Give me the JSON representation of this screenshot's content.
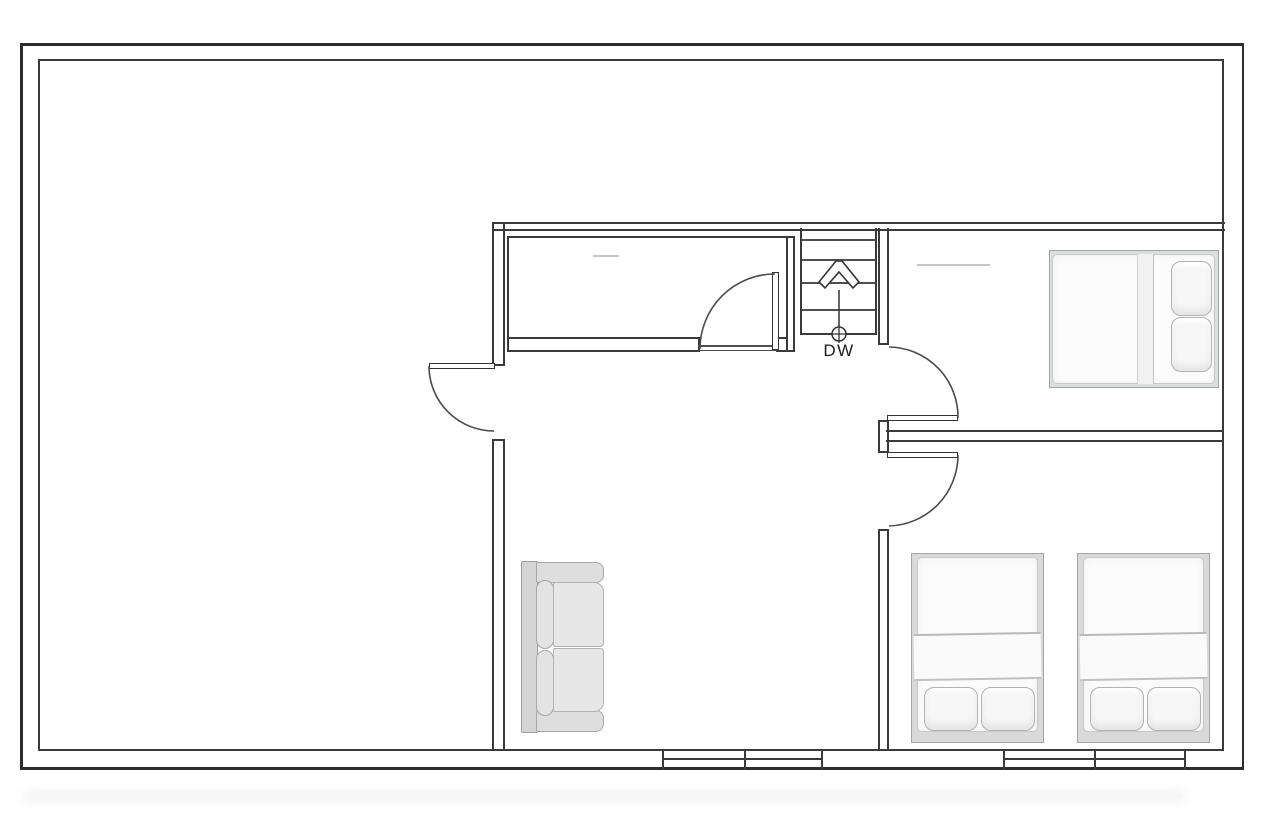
{
  "floor_plan": {
    "stairs": {
      "label": "DW",
      "direction_arrow": "up",
      "tread_count": 5,
      "fixture_symbol": "circle-cross"
    },
    "rooms": [
      {
        "name": "large-open-room",
        "furniture": []
      },
      {
        "name": "top-middle-room",
        "furniture": []
      },
      {
        "name": "central-room",
        "furniture": [
          "two-seat-sofa"
        ]
      },
      {
        "name": "bedroom-top-right",
        "furniture": [
          "double-bed-horizontal"
        ]
      },
      {
        "name": "bedroom-bottom-right",
        "furniture": [
          "bed-vertical",
          "bed-vertical"
        ]
      }
    ],
    "door_count": 4,
    "window_panel_count": 4,
    "colors": {
      "wall_line": "#2d2d2d",
      "light_line": "#4f4f4f",
      "faint_line": "#c6c6c6",
      "furniture_fill": "#f6f6f6",
      "platform_fill": "#dcdede",
      "sofa_fill": "#e3e3e3",
      "background": "#ffffff"
    }
  }
}
